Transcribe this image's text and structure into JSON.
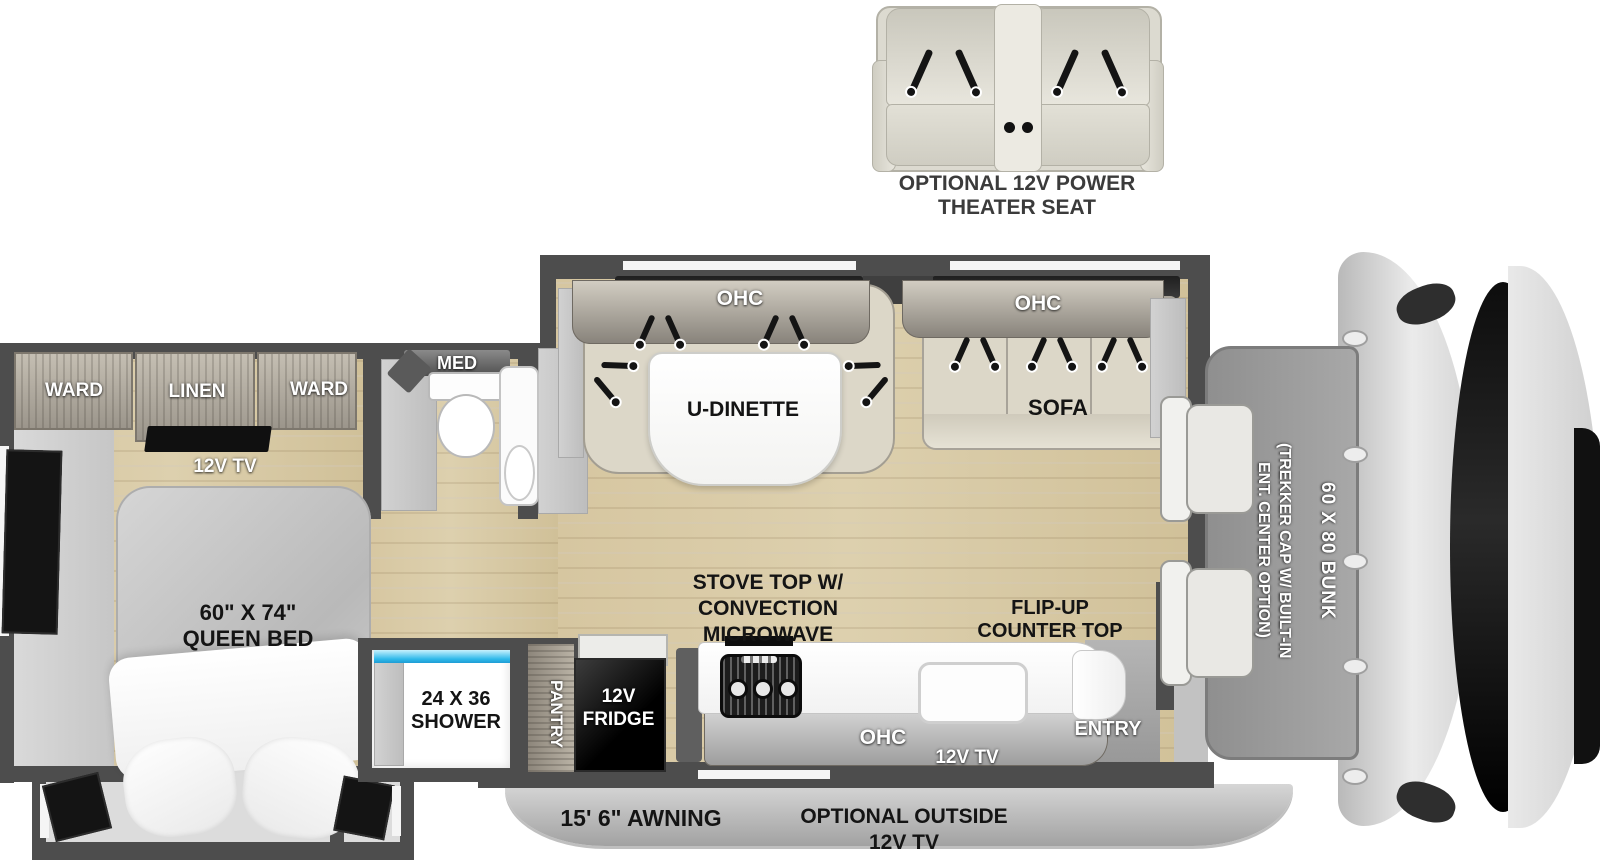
{
  "inset": {
    "line1": "OPTIONAL 12V POWER",
    "line2": "THEATER SEAT"
  },
  "bedroom": {
    "ward_left": "WARD",
    "linen": "LINEN",
    "ward_right": "WARD",
    "tv": "12V TV",
    "bed_line1": "60\" X 74\"",
    "bed_line2": "QUEEN BED"
  },
  "bathroom": {
    "med": "MED"
  },
  "shower": {
    "line1": "24 X 36",
    "line2": "SHOWER"
  },
  "kitchen": {
    "pantry": "PANTRY",
    "fridge_line1": "12V",
    "fridge_line2": "FRIDGE",
    "stove_line1": "STOVE TOP W/",
    "stove_line2": "CONVECTION",
    "stove_line3": "MICROWAVE",
    "flip_line1": "FLIP-UP",
    "flip_line2": "COUNTER TOP",
    "ohc": "OHC",
    "tv": "12V TV",
    "entry": "ENTRY"
  },
  "dinette": {
    "ohc": "OHC",
    "label": "U-DINETTE"
  },
  "sofa": {
    "ohc": "OHC",
    "label": "SOFA"
  },
  "cab": {
    "bunk": "60 X 80 BUNK",
    "trekker_line1": "(TREKKER CAP W/ BUILT-IN",
    "trekker_line2": "ENT. CENTER OPTION)"
  },
  "awning": {
    "label": "15' 6\" AWNING",
    "tv_line1": "OPTIONAL OUTSIDE",
    "tv_line2": "12V TV"
  },
  "colors": {
    "wall": "#4d4d4d",
    "floor_wood": "#d8c8a4",
    "accent_water": "#2fb9ea"
  }
}
